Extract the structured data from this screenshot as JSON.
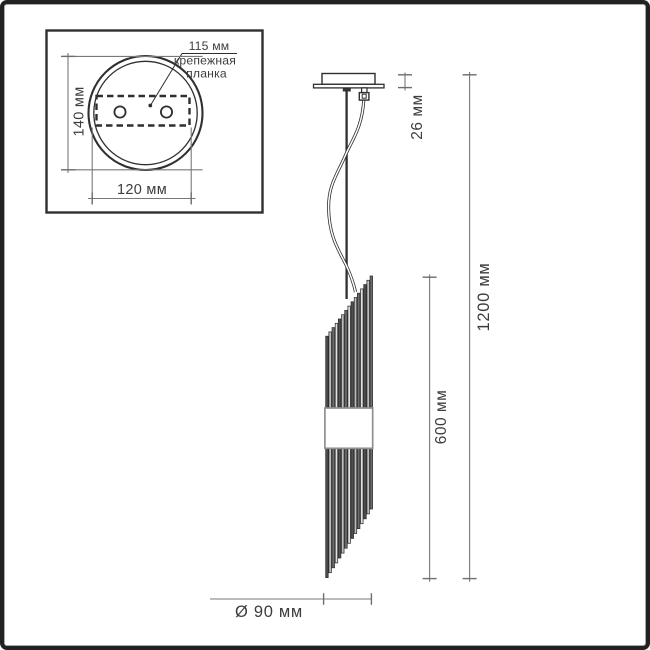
{
  "inset": {
    "hole_spacing_label": "115 мм",
    "bracket_label_line1": "крепежная",
    "bracket_label_line2": "планка",
    "height_label": "140 мм",
    "width_label": "120 мм"
  },
  "pendant": {
    "canopy_height_label": "26 мм",
    "total_height_label": "1200 мм",
    "body_height_label": "600 мм",
    "diameter_label": "Ø 90 мм"
  },
  "colors": {
    "outline": "#2f2f2f",
    "dimension_line": "#787878",
    "text": "#3d3d3d",
    "frame": "#212121",
    "background": "#ffffff"
  }
}
